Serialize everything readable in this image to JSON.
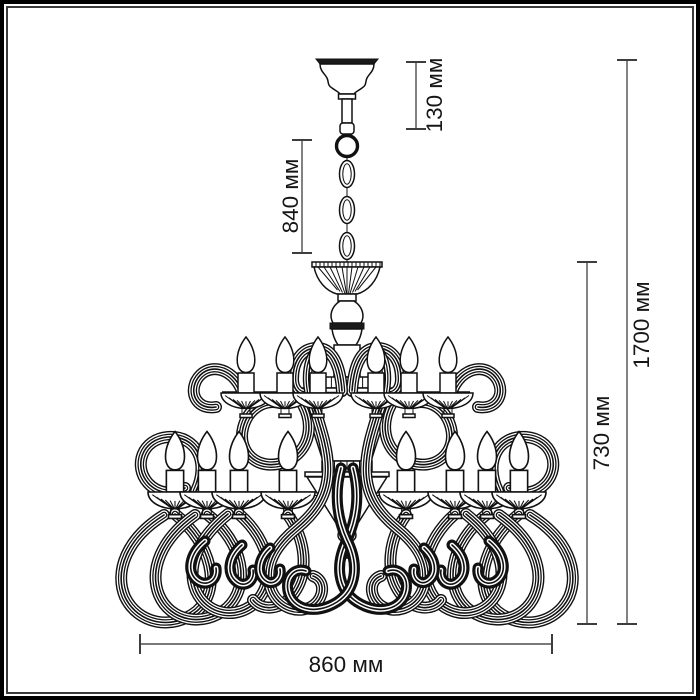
{
  "dimensions": {
    "canopy_drop": "130 мм",
    "suspension_length": "840 мм",
    "overall_height": "1700 мм",
    "fixture_height": "730 мм",
    "diameter": "860 мм"
  },
  "colors": {
    "drawing_line": "#111111",
    "dimension_line": "#4d4d4d",
    "label_text": "#161616",
    "background": "#ffffff",
    "frame": "#000000"
  }
}
